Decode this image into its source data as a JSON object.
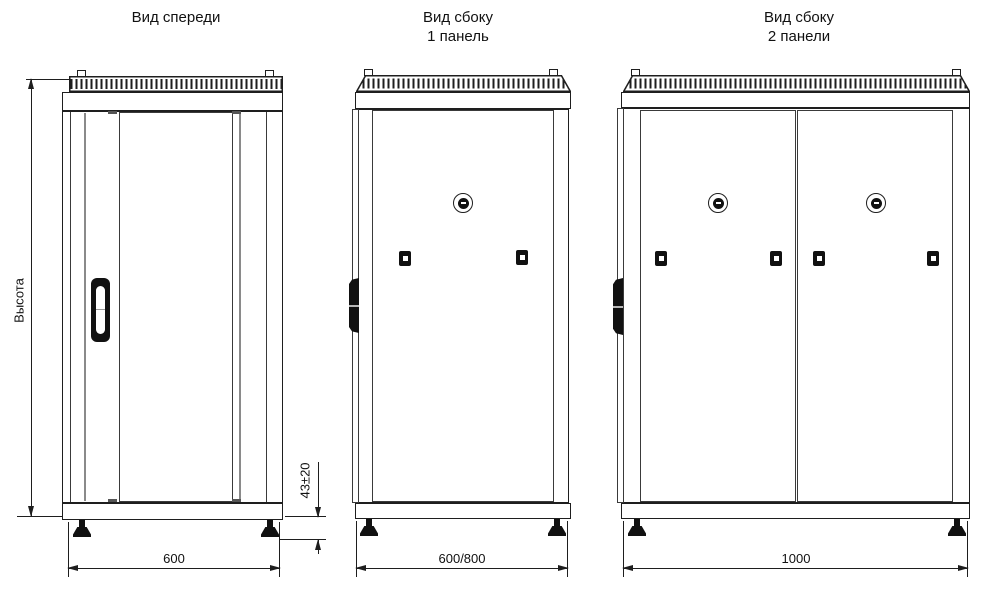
{
  "views": {
    "front": {
      "title": "Вид спереди",
      "dimensions": {
        "height": "Высота",
        "width": "600",
        "foot_height": "43±20"
      }
    },
    "side_one_panel": {
      "title": [
        "Вид сбоку",
        "1 панель"
      ],
      "dimensions": {
        "width": "600/800"
      }
    },
    "side_two_panels": {
      "title": [
        "Вид сбоку",
        "2 панели"
      ],
      "dimensions": {
        "width": "1000"
      }
    }
  },
  "colors": {
    "line": "#1e1e1e",
    "grey_line": "#8a8a8a",
    "fill": "#111111",
    "background": "#ffffff"
  }
}
